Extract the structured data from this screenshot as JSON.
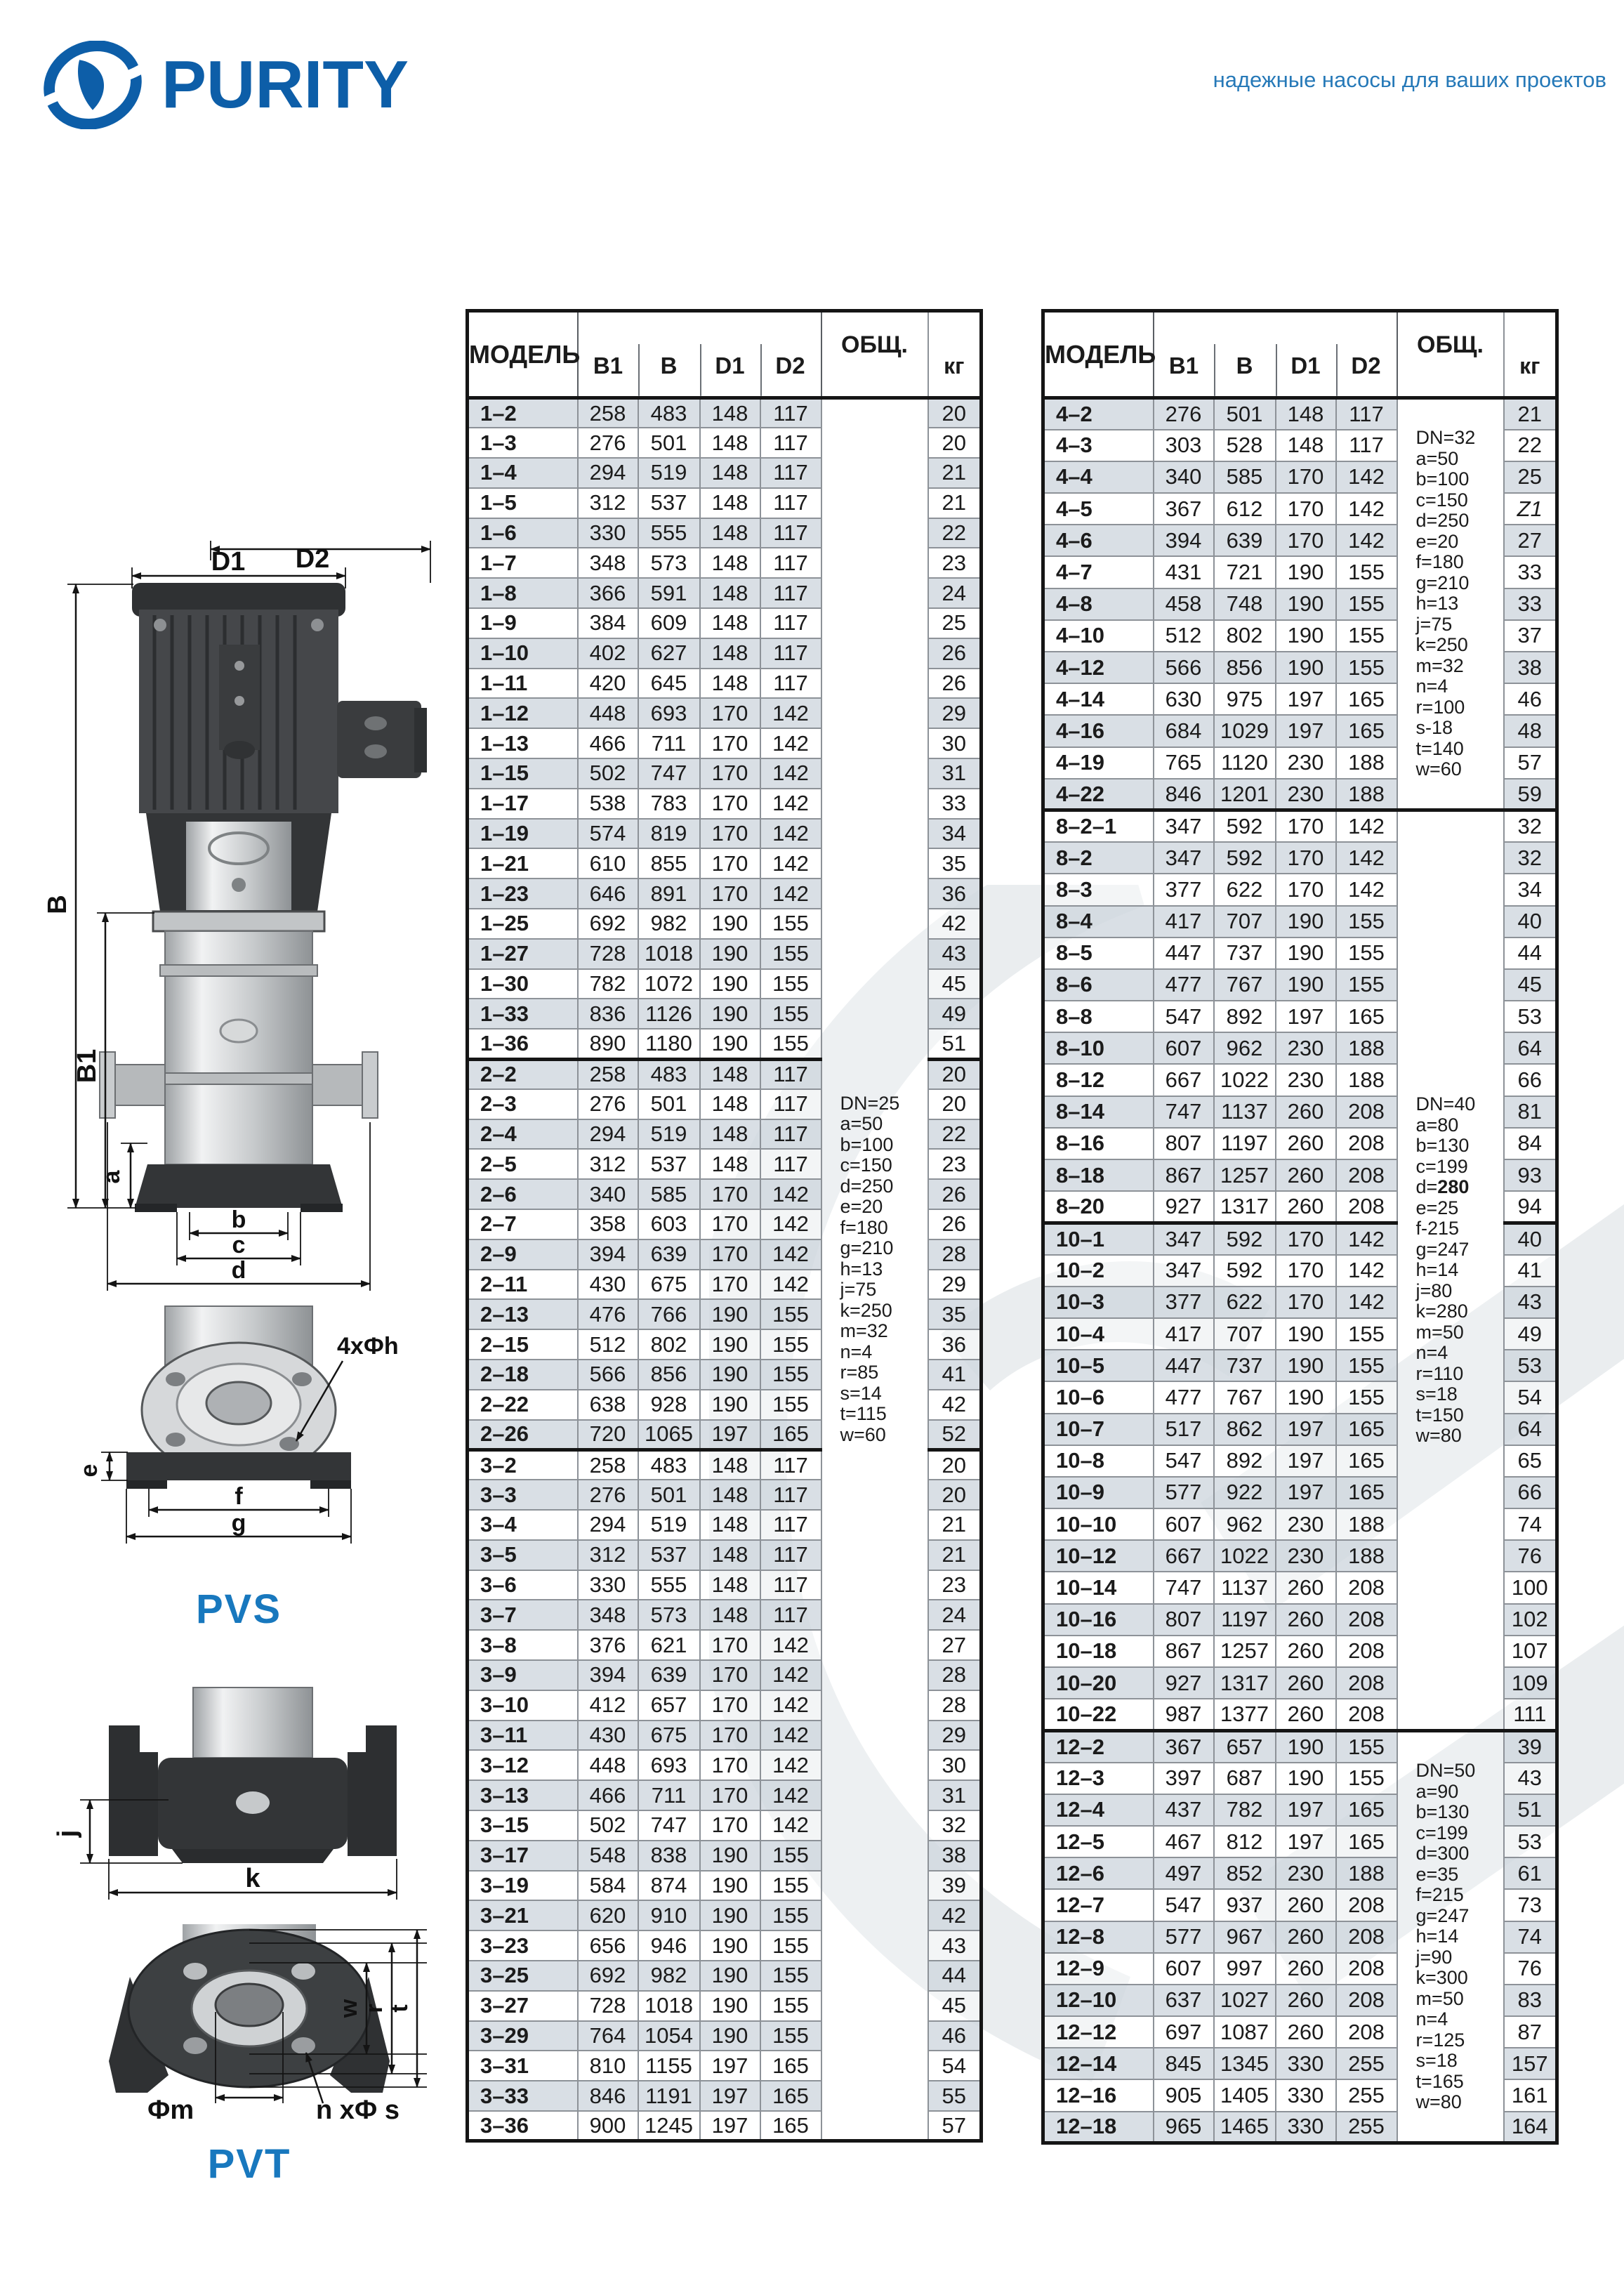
{
  "header": {
    "logo_text": "PURITY",
    "tagline": "надежные насосы для ваших проектов"
  },
  "icons": {
    "purity_logo": "swirl-ellipse-mark",
    "watermark": "logo-swoosh-watermark"
  },
  "colors": {
    "brand_blue": "#0d5ea8",
    "tagline_blue": "#2679b8",
    "diagram_label_blue": "#1878be",
    "row_shade": "#d1d8df",
    "border_dark": "#151515",
    "border_gray": "#8d9298"
  },
  "diagrams": {
    "pvs": {
      "label": "PVS",
      "dims": {
        "d2": "D2",
        "d1": "D1",
        "b": "B",
        "b1": "B1",
        "a": "a",
        "width_b": "b",
        "width_c": "c",
        "width_d": "d",
        "e": "e",
        "f": "f",
        "g": "g",
        "holes": "4xФh"
      }
    },
    "pvt": {
      "label": "PVT",
      "dims": {
        "j": "j",
        "k": "k",
        "w": "w",
        "r": "r",
        "t": "t",
        "m": "Фm",
        "holes": "n xФ s"
      }
    }
  },
  "tables": {
    "columns": {
      "model": "МОДЕЛЬ",
      "b1": "B1",
      "b": "B",
      "d1": "D1",
      "d2": "D2",
      "total": "ОБЩ.",
      "kg": "кг"
    },
    "left": {
      "obsh_spans": [
        {
          "at": 0,
          "rows": 58,
          "lines": [
            "DN=25",
            "a=50",
            "b=100",
            "c=150",
            "d=250",
            "e=20",
            "f=180",
            "g=210",
            "h=13",
            "j=75",
            "k=250",
            "m=32",
            "n=4",
            "r=85",
            "s=14",
            "t=115",
            "w=60"
          ]
        }
      ],
      "sections": [
        {
          "rows": [
            [
              "1–2",
              258,
              483,
              148,
              117,
              20
            ],
            [
              "1–3",
              276,
              501,
              148,
              117,
              20
            ],
            [
              "1–4",
              294,
              519,
              148,
              117,
              21
            ],
            [
              "1–5",
              312,
              537,
              148,
              117,
              21
            ],
            [
              "1–6",
              330,
              555,
              148,
              117,
              22
            ],
            [
              "1–7",
              348,
              573,
              148,
              117,
              23
            ],
            [
              "1–8",
              366,
              591,
              148,
              117,
              24
            ],
            [
              "1–9",
              384,
              609,
              148,
              117,
              25
            ],
            [
              "1–10",
              402,
              627,
              148,
              117,
              26
            ],
            [
              "1–11",
              420,
              645,
              148,
              117,
              26
            ],
            [
              "1–12",
              448,
              693,
              170,
              142,
              29
            ],
            [
              "1–13",
              466,
              711,
              170,
              142,
              30
            ],
            [
              "1–15",
              502,
              747,
              170,
              142,
              31
            ],
            [
              "1–17",
              538,
              783,
              170,
              142,
              33
            ],
            [
              "1–19",
              574,
              819,
              170,
              142,
              34
            ],
            [
              "1–21",
              610,
              855,
              170,
              142,
              35
            ],
            [
              "1–23",
              646,
              891,
              170,
              142,
              36
            ],
            [
              "1–25",
              692,
              982,
              190,
              155,
              42
            ],
            [
              "1–27",
              728,
              1018,
              190,
              155,
              43
            ],
            [
              "1–30",
              782,
              1072,
              190,
              155,
              45
            ],
            [
              "1–33",
              836,
              1126,
              190,
              155,
              49
            ],
            [
              "1–36",
              890,
              1180,
              190,
              155,
              51
            ]
          ]
        },
        {
          "rows": [
            [
              "2–2",
              258,
              483,
              148,
              117,
              20
            ],
            [
              "2–3",
              276,
              501,
              148,
              117,
              20
            ],
            [
              "2–4",
              294,
              519,
              148,
              117,
              22
            ],
            [
              "2–5",
              312,
              537,
              148,
              117,
              23
            ],
            [
              "2–6",
              340,
              585,
              170,
              142,
              26
            ],
            [
              "2–7",
              358,
              603,
              170,
              142,
              26
            ],
            [
              "2–9",
              394,
              639,
              170,
              142,
              28
            ],
            [
              "2–11",
              430,
              675,
              170,
              142,
              29
            ],
            [
              "2–13",
              476,
              766,
              190,
              155,
              35
            ],
            [
              "2–15",
              512,
              802,
              190,
              155,
              36
            ],
            [
              "2–18",
              566,
              856,
              190,
              155,
              41
            ],
            [
              "2–22",
              638,
              928,
              190,
              155,
              42
            ],
            [
              "2–26",
              720,
              1065,
              197,
              165,
              52
            ]
          ]
        },
        {
          "rows": [
            [
              "3–2",
              258,
              483,
              148,
              117,
              20
            ],
            [
              "3–3",
              276,
              501,
              148,
              117,
              20
            ],
            [
              "3–4",
              294,
              519,
              148,
              117,
              21
            ],
            [
              "3–5",
              312,
              537,
              148,
              117,
              21
            ],
            [
              "3–6",
              330,
              555,
              148,
              117,
              23
            ],
            [
              "3–7",
              348,
              573,
              148,
              117,
              24
            ],
            [
              "3–8",
              376,
              621,
              170,
              142,
              27
            ],
            [
              "3–9",
              394,
              639,
              170,
              142,
              28
            ],
            [
              "3–10",
              412,
              657,
              170,
              142,
              28
            ],
            [
              "3–11",
              430,
              675,
              170,
              142,
              29
            ],
            [
              "3–12",
              448,
              693,
              170,
              142,
              30
            ],
            [
              "3–13",
              466,
              711,
              170,
              142,
              31
            ],
            [
              "3–15",
              502,
              747,
              170,
              142,
              32
            ],
            [
              "3–17",
              548,
              838,
              190,
              155,
              38
            ],
            [
              "3–19",
              584,
              874,
              190,
              155,
              39
            ],
            [
              "3–21",
              620,
              910,
              190,
              155,
              42
            ],
            [
              "3–23",
              656,
              946,
              190,
              155,
              43
            ],
            [
              "3–25",
              692,
              982,
              190,
              155,
              44
            ],
            [
              "3–27",
              728,
              1018,
              190,
              155,
              45
            ],
            [
              "3–29",
              764,
              1054,
              190,
              155,
              46
            ],
            [
              "3–31",
              810,
              1155,
              197,
              165,
              54
            ],
            [
              "3–33",
              846,
              1191,
              197,
              165,
              55
            ],
            [
              "3–36",
              900,
              1245,
              197,
              165,
              57
            ]
          ]
        }
      ]
    },
    "right": {
      "obsh_spans": [
        {
          "at": 0,
          "rows": 13,
          "lines": [
            "DN=32",
            "a=50",
            "b=100",
            "c=150",
            "d=250",
            "e=20",
            "f=180",
            "g=210",
            "h=13",
            "j=75",
            "k=250",
            "m=32",
            "n=4",
            "r=100",
            "s-18",
            "t=140",
            "w=60"
          ]
        },
        {
          "at": 13,
          "rows": 29,
          "lines": [
            "DN=40",
            "a=80",
            "b=130",
            "c=199",
            "d=**280**",
            "e=25",
            "f-215",
            "g=247",
            "h=14",
            "j=80",
            "k=280",
            "m=50",
            "n=4",
            "r=110",
            "s=18",
            "t=150",
            "w=80"
          ]
        },
        {
          "at": 42,
          "rows": 13,
          "lines": [
            "DN=50",
            "a=90",
            "b=130",
            "c=199",
            "d=300",
            "e=35",
            "f=215",
            "g=247",
            "h=14",
            "j=90",
            "k=300",
            "m=50",
            "n=4",
            "r=125",
            "s=18",
            "t=165",
            "w=80"
          ]
        }
      ],
      "sections": [
        {
          "rows": [
            [
              "4–2",
              276,
              501,
              148,
              117,
              "21"
            ],
            [
              "4–3",
              303,
              528,
              148,
              117,
              "22"
            ],
            [
              "4–4",
              340,
              585,
              170,
              142,
              "25"
            ],
            [
              "4–5",
              367,
              612,
              170,
              142,
              "Z1"
            ],
            [
              "4–6",
              394,
              639,
              170,
              142,
              "27"
            ],
            [
              "4–7",
              431,
              721,
              190,
              155,
              "33"
            ],
            [
              "4–8",
              458,
              748,
              190,
              155,
              "33"
            ],
            [
              "4–10",
              512,
              802,
              190,
              155,
              "37"
            ],
            [
              "4–12",
              566,
              856,
              190,
              155,
              "38"
            ],
            [
              "4–14",
              630,
              975,
              197,
              165,
              "46"
            ],
            [
              "4–16",
              684,
              1029,
              197,
              165,
              "48"
            ],
            [
              "4–19",
              765,
              1120,
              230,
              188,
              "57"
            ],
            [
              "4–22",
              846,
              1201,
              230,
              188,
              "59"
            ]
          ]
        },
        {
          "rows": [
            [
              "8–2–1",
              347,
              592,
              170,
              142,
              32
            ],
            [
              "8–2",
              347,
              592,
              170,
              142,
              32
            ],
            [
              "8–3",
              377,
              622,
              170,
              142,
              34
            ],
            [
              "8–4",
              417,
              707,
              190,
              155,
              40
            ],
            [
              "8–5",
              447,
              737,
              190,
              155,
              44
            ],
            [
              "8–6",
              477,
              767,
              190,
              155,
              45
            ],
            [
              "8–8",
              547,
              892,
              197,
              165,
              53
            ],
            [
              "8–10",
              607,
              962,
              230,
              188,
              64
            ],
            [
              "8–12",
              667,
              1022,
              230,
              188,
              66
            ],
            [
              "8–14",
              747,
              1137,
              260,
              208,
              81
            ],
            [
              "8–16",
              807,
              1197,
              260,
              208,
              84
            ],
            [
              "8–18",
              867,
              1257,
              260,
              208,
              93
            ],
            [
              "8–20",
              927,
              1317,
              260,
              208,
              94
            ]
          ]
        },
        {
          "rows": [
            [
              "10–1",
              347,
              592,
              170,
              142,
              40
            ],
            [
              "10–2",
              347,
              592,
              170,
              142,
              41
            ],
            [
              "10–3",
              377,
              622,
              170,
              142,
              43
            ],
            [
              "10–4",
              417,
              707,
              190,
              155,
              49
            ],
            [
              "10–5",
              447,
              737,
              190,
              155,
              53
            ],
            [
              "10–6",
              477,
              767,
              190,
              155,
              54
            ],
            [
              "10–7",
              517,
              862,
              197,
              165,
              64
            ],
            [
              "10–8",
              547,
              892,
              197,
              165,
              65
            ],
            [
              "10–9",
              577,
              922,
              197,
              165,
              66
            ],
            [
              "10–10",
              607,
              962,
              230,
              188,
              74
            ],
            [
              "10–12",
              667,
              1022,
              230,
              188,
              76
            ],
            [
              "10–14",
              747,
              1137,
              260,
              208,
              100
            ],
            [
              "10–16",
              807,
              1197,
              260,
              208,
              102
            ],
            [
              "10–18",
              867,
              1257,
              260,
              208,
              107
            ],
            [
              "10–20",
              927,
              1317,
              260,
              208,
              109
            ],
            [
              "10–22",
              987,
              1377,
              260,
              208,
              111
            ]
          ]
        },
        {
          "rows": [
            [
              "12–2",
              367,
              657,
              190,
              155,
              39
            ],
            [
              "12–3",
              397,
              687,
              190,
              155,
              43
            ],
            [
              "12–4",
              437,
              782,
              197,
              165,
              51
            ],
            [
              "12–5",
              467,
              812,
              197,
              165,
              53
            ],
            [
              "12–6",
              497,
              852,
              230,
              188,
              61
            ],
            [
              "12–7",
              547,
              937,
              260,
              208,
              73
            ],
            [
              "12–8",
              577,
              967,
              260,
              208,
              74
            ],
            [
              "12–9",
              607,
              997,
              260,
              208,
              76
            ],
            [
              "12–10",
              637,
              1027,
              260,
              208,
              83
            ],
            [
              "12–12",
              697,
              1087,
              260,
              208,
              87
            ],
            [
              "12–14",
              845,
              1345,
              330,
              255,
              157
            ],
            [
              "12–16",
              905,
              1405,
              330,
              255,
              161
            ],
            [
              "12–18",
              965,
              1465,
              330,
              255,
              164
            ]
          ]
        }
      ]
    }
  }
}
